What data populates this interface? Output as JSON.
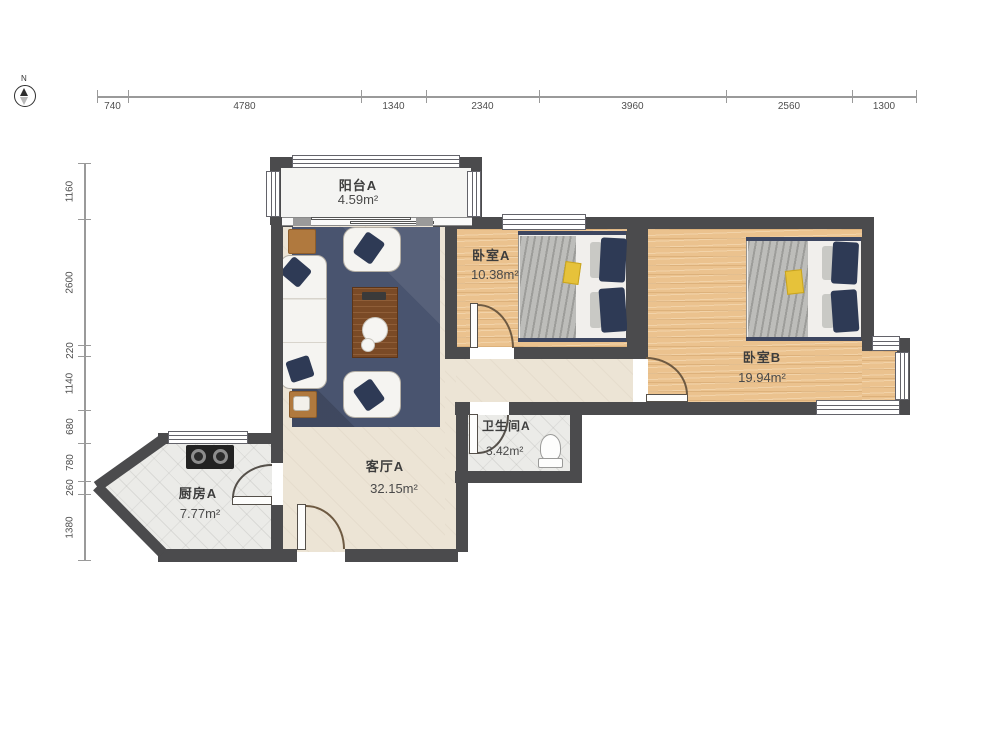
{
  "compass": {
    "label": "N"
  },
  "rulers": {
    "top": {
      "values": [
        "740",
        "4780",
        "1340",
        "2340",
        "3960",
        "2560",
        "1300"
      ]
    },
    "left": {
      "values": [
        "1160",
        "2600",
        "220",
        "1140",
        "680",
        "780",
        "260",
        "1380"
      ]
    }
  },
  "rooms": {
    "balcony": {
      "name": "阳台A",
      "area": "4.59m²"
    },
    "bedroom_a": {
      "name": "卧室A",
      "area": "10.38m²"
    },
    "bedroom_b": {
      "name": "卧室B",
      "area": "19.94m²"
    },
    "bathroom": {
      "name": "卫生间A",
      "area": "3.42m²"
    },
    "living": {
      "name": "客厅A",
      "area": "32.15m²"
    },
    "kitchen": {
      "name": "厨房A",
      "area": "7.77m²"
    }
  },
  "colors": {
    "wall": "#4b4b4d",
    "wood_floor": "#ebc28e",
    "living_floor": "#ece4d5",
    "kitchen_bath_floor": "#ebebe8",
    "rug": "#49546f",
    "pillow_navy": "#2e3a55",
    "coffee_table": "#7a4a26"
  }
}
